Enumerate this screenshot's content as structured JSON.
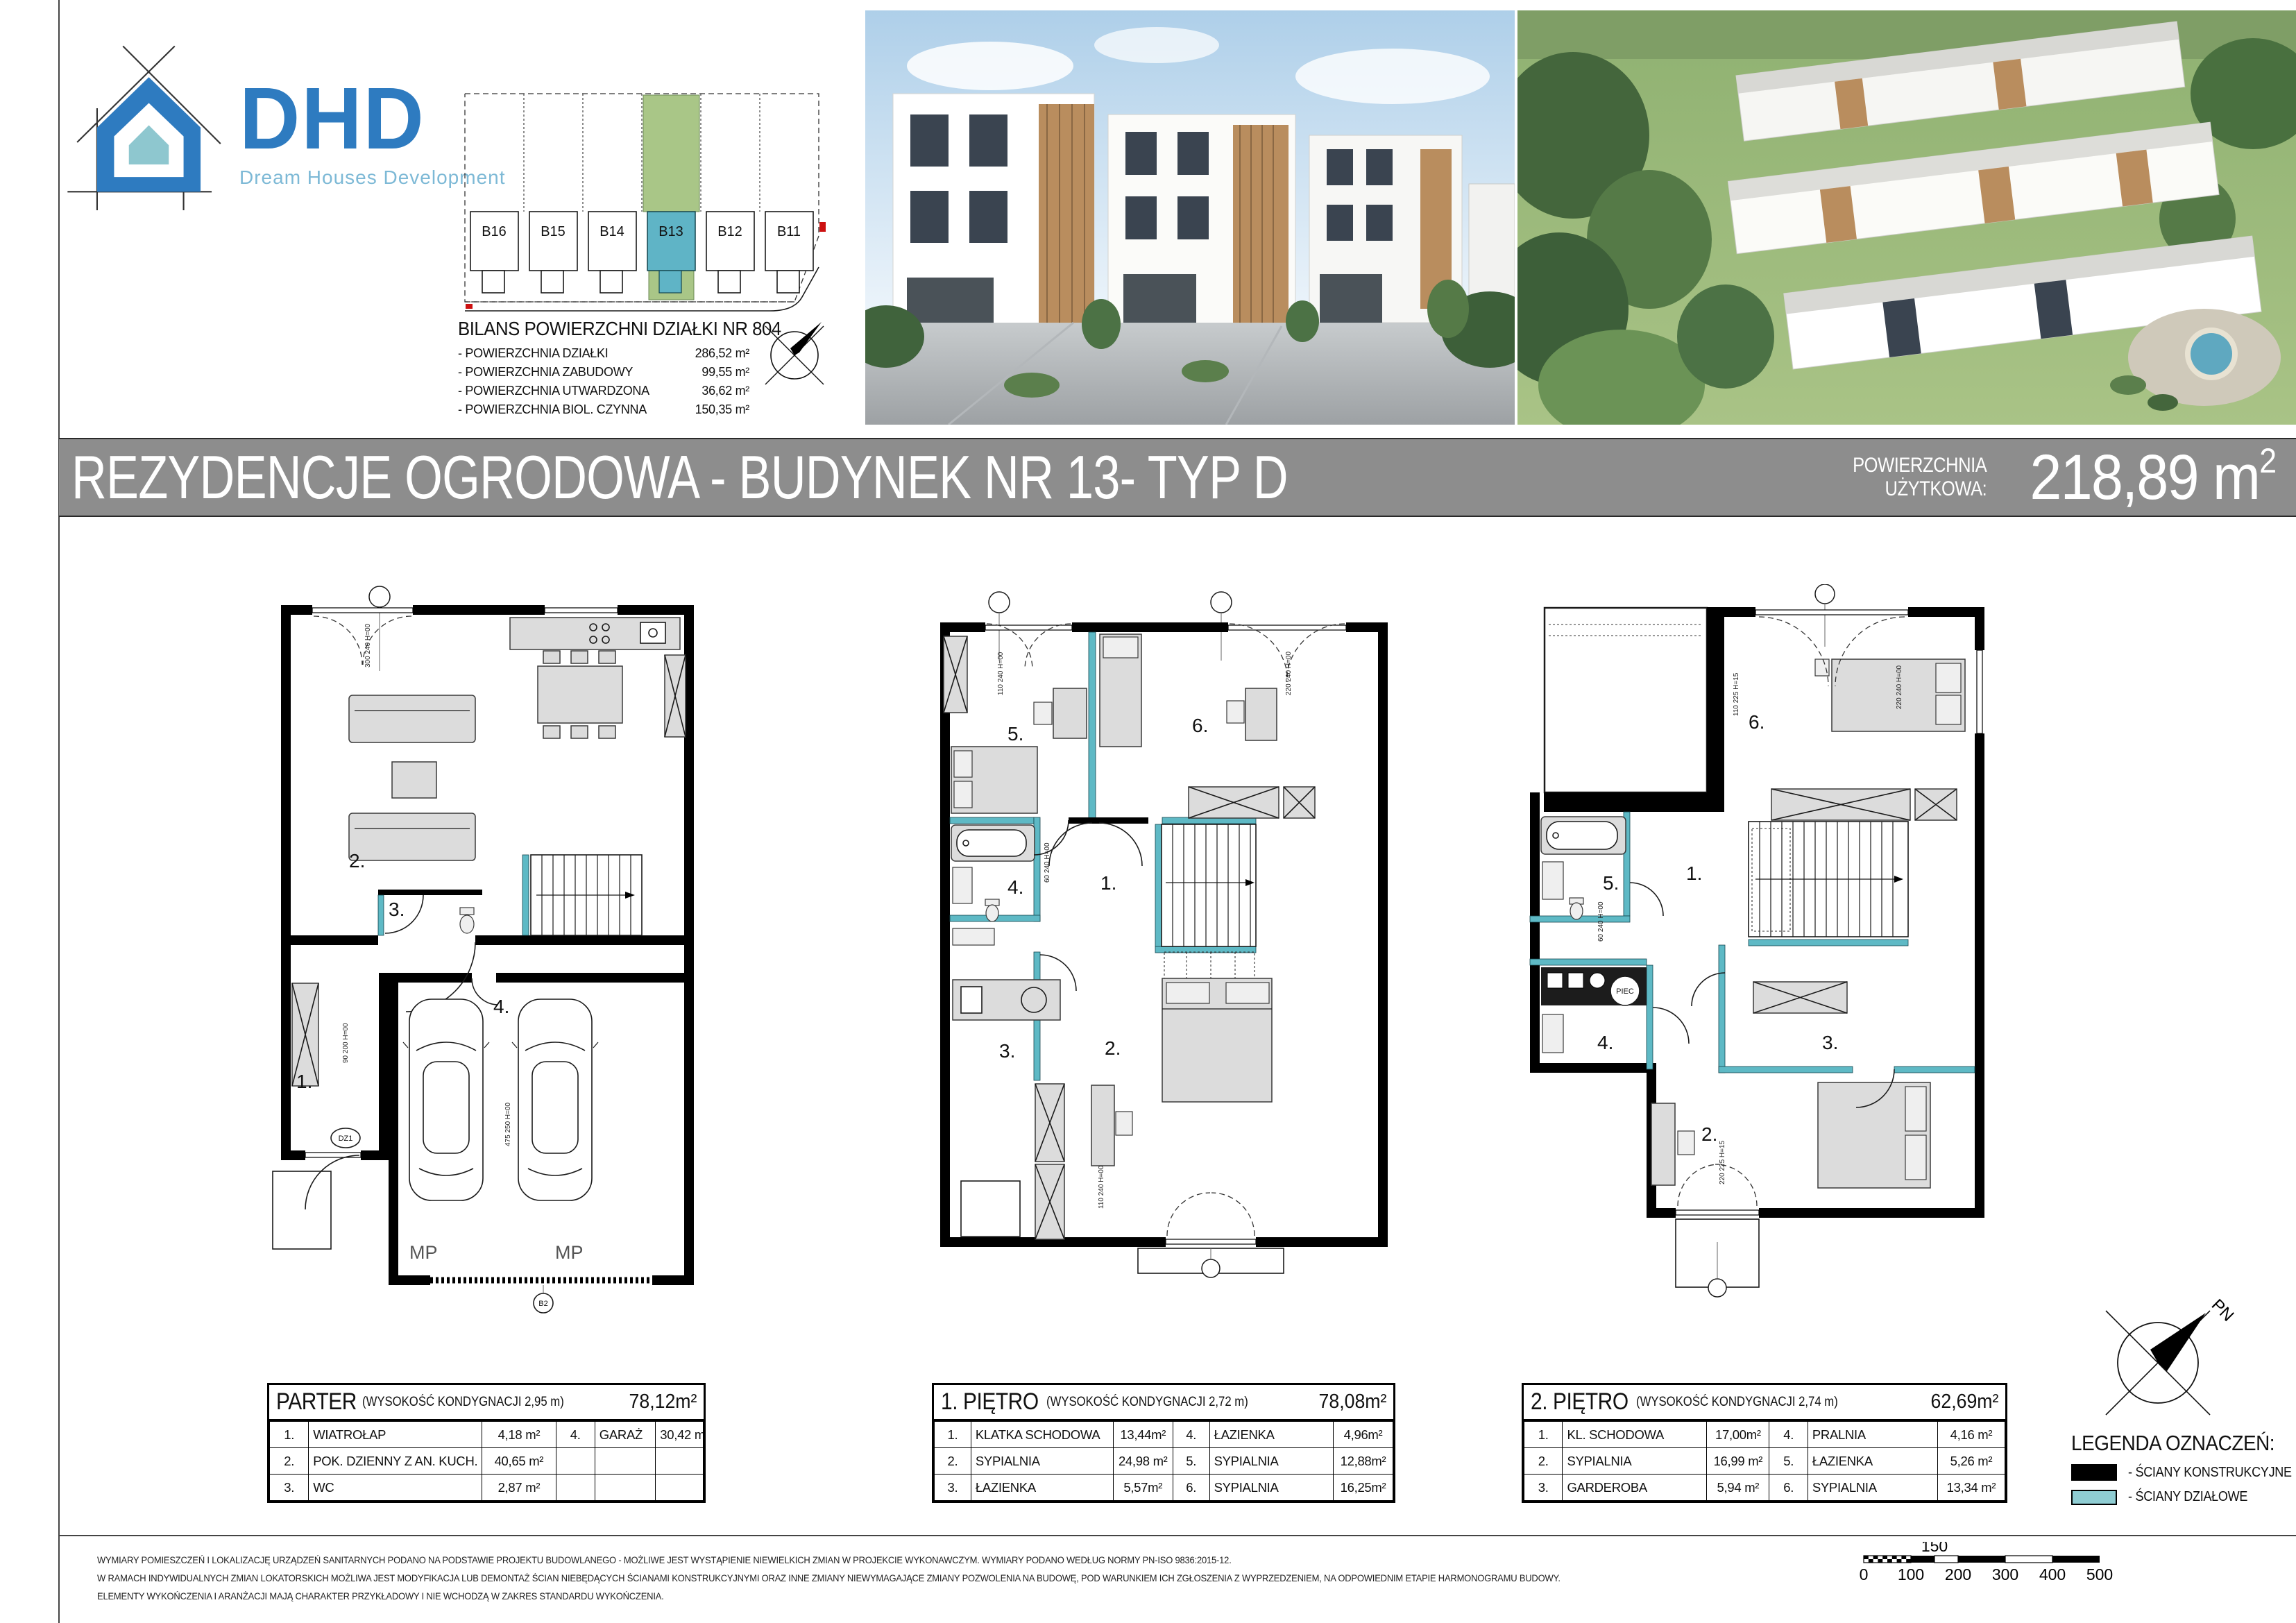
{
  "logo": {
    "brand": "DHD",
    "tagline": "Dream Houses Development"
  },
  "site_plan": {
    "plots": [
      "B16",
      "B15",
      "B14",
      "B13",
      "B12",
      "B11"
    ],
    "highlighted_plot": "B13",
    "bilans_title": "BILANS POWIERZCHNI DZIAŁKI NR 804",
    "bilans": [
      {
        "label": "- POWIERZCHNIA DZIAŁKI",
        "value": "286,52 m²"
      },
      {
        "label": "- POWIERZCHNIA ZABUDOWY",
        "value": "99,55 m²"
      },
      {
        "label": "- POWIERZCHNIA  UTWARDZONA",
        "value": "36,62 m²"
      },
      {
        "label": "- POWIERZCHNIA  BIOL. CZYNNA",
        "value": "150,35 m²"
      }
    ],
    "colors": {
      "garden_green": "#a9c687",
      "building_teal": "#5fb4c6"
    }
  },
  "title_bar": {
    "title": "REZYDENCJE OGRODOWA - BUDYNEK NR 13- TYP D",
    "area_label_1": "POWIERZCHNIA",
    "area_label_2": "UŻYTKOWA:",
    "area_value": "218,89",
    "area_unit": " m",
    "area_sup": "2",
    "bar_color": "#8d8d8d"
  },
  "plans": {
    "parter": {
      "rooms": {
        "r1": "1.",
        "r2": "2.",
        "r3": "3.",
        "r4": "4."
      },
      "mp1": "MP",
      "mp2": "MP",
      "dz1": "DZ1",
      "b2": "B2",
      "dim1": "90 200 H=00",
      "dim2": "475 250 H=00",
      "dim3": "300 240 H=00"
    },
    "pietro1": {
      "rooms": {
        "r1": "1.",
        "r2": "2.",
        "r3": "3.",
        "r4": "4.",
        "r5": "5.",
        "r6": "6."
      },
      "dim1": "110 240 H=00",
      "dim2": "220 240 H=00",
      "dim3": "60 240 H=00",
      "dim4": "110 240 H=00"
    },
    "pietro2": {
      "rooms": {
        "r1": "1.",
        "r2": "2.",
        "r3": "3.",
        "r4": "4.",
        "r5": "5.",
        "r6": "6."
      },
      "piec": "PIEC",
      "dim1": "110 225 H=15",
      "dim2": "220 240 H=00",
      "dim3": "60 240 H=00",
      "dim4": "220 225 H=15"
    }
  },
  "tables": [
    {
      "name": "PARTER",
      "note": "(WYSOKOŚĆ KONDYGNACJI 2,95 m)",
      "total": "78,12m²",
      "rows": [
        {
          "n1": "1.",
          "name1": "WIATROŁAP",
          "a1": "4,18 m²",
          "n2": "4.",
          "name2": "GARAŻ",
          "a2": "30,42 m²"
        },
        {
          "n1": "2.",
          "name1": "POK. DZIENNY Z AN. KUCH.",
          "a1": "40,65 m²",
          "n2": "",
          "name2": "",
          "a2": ""
        },
        {
          "n1": "3.",
          "name1": "WC",
          "a1": "2,87 m²",
          "n2": "",
          "name2": "",
          "a2": ""
        }
      ]
    },
    {
      "name": "1. PIĘTRO",
      "note": "(WYSOKOŚĆ KONDYGNACJI 2,72 m)",
      "total": "78,08m²",
      "rows": [
        {
          "n1": "1.",
          "name1": "KLATKA SCHODOWA",
          "a1": "13,44m²",
          "n2": "4.",
          "name2": "ŁAZIENKA",
          "a2": "4,96m²"
        },
        {
          "n1": "2.",
          "name1": "SYPIALNIA",
          "a1": "24,98 m²",
          "n2": "5.",
          "name2": "SYPIALNIA",
          "a2": "12,88m²"
        },
        {
          "n1": "3.",
          "name1": "ŁAZIENKA",
          "a1": "5,57m²",
          "n2": "6.",
          "name2": "SYPIALNIA",
          "a2": "16,25m²"
        }
      ]
    },
    {
      "name": "2. PIĘTRO",
      "note": "(WYSOKOŚĆ KONDYGNACJI 2,74 m)",
      "total": "62,69m²",
      "rows": [
        {
          "n1": "1.",
          "name1": "KL. SCHODOWA",
          "a1": "17,00m²",
          "n2": "4.",
          "name2": "PRALNIA",
          "a2": "4,16 m²"
        },
        {
          "n1": "2.",
          "name1": "SYPIALNIA",
          "a1": "16,99 m²",
          "n2": "5.",
          "name2": "ŁAZIENKA",
          "a2": "5,26 m²"
        },
        {
          "n1": "3.",
          "name1": "GARDEROBA",
          "a1": "5,94 m²",
          "n2": "6.",
          "name2": "SYPIALNIA",
          "a2": "13,34 m²"
        }
      ]
    }
  ],
  "legend": {
    "title": "LEGENDA OZNACZEŃ:",
    "items": [
      {
        "label": "- ŚCIANY KONSTRUKCYJNE",
        "color": "#000000"
      },
      {
        "label": "- ŚCIANY DZIAŁOWE",
        "color": "#8fcdd3"
      }
    ]
  },
  "compass": {
    "label": "PN"
  },
  "scale_bar": {
    "ticks": [
      "0",
      "100",
      "200",
      "300",
      "400",
      "500"
    ],
    "mid": "150"
  },
  "footer": [
    "WYMIARY POMIESZCZEŃ I LOKALIZACJĘ URZĄDZEŃ SANITARNYCH PODANO NA PODSTAWIE PROJEKTU BUDOWLANEGO - MOŻLIWE JEST WYSTĄPIENIE NIEWIELKICH ZMIAN W PROJEKCIE WYKONAWCZYM. WYMIARY PODANO WEDŁUG NORMY PN-ISO 9836:2015-12.",
    "W RAMACH INDYWIDUALNYCH ZMIAN LOKATORSKICH MOŻLIWA JEST MODYFIKACJA LUB DEMONTAŻ ŚCIAN NIEBĘDĄCYCH ŚCIANAMI KONSTRUKCYJNYMI ORAZ INNE ZMIANY NIEWYMAGAJĄCE ZMIANY POZWOLENIA NA BUDOWĘ, POD WARUNKIEM ICH ZGŁOSZENIA Z WYPRZEDZENIEM, NA ODPOWIEDNIM ETAPIE HARMONOGRAMU BUDOWY.",
    "ELEMENTY WYKOŃCZENIA I ARANŻACJI MAJĄ CHARAKTER PRZYKŁADOWY I NIE WCHODZĄ W ZAKRES STANDARDU WYKOŃCZENIA."
  ]
}
